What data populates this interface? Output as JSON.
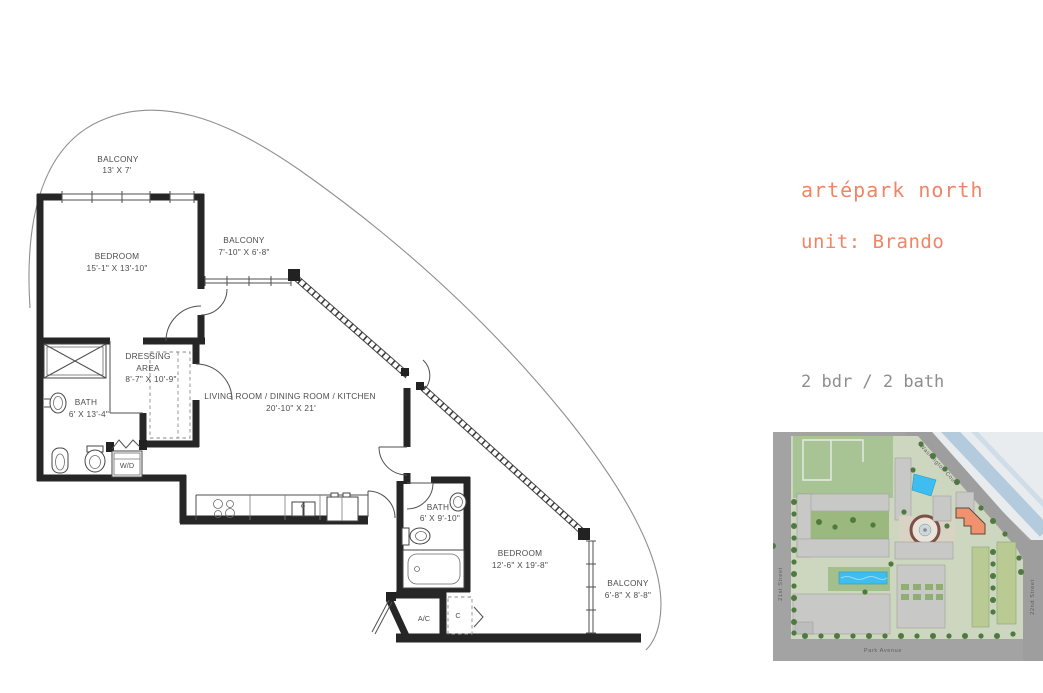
{
  "info_panel": {
    "project_title": "artépark north",
    "unit_line": "unit: Brando",
    "spec_lines": [
      "2 bdr / 2 bath",
      "interior: 1314 sf.",
      "balconies: 223 sf."
    ],
    "accent_color": "#f08566",
    "text_color": "#8e8e8e"
  },
  "floor_plan": {
    "label_color": "#4d4d4d",
    "rooms": {
      "balcony1": {
        "name": "BALCONY",
        "dims": "13' X 7'"
      },
      "bedroom1": {
        "name": "BEDROOM",
        "dims": "15'-1\" X 13'-10\""
      },
      "balcony2": {
        "name": "BALCONY",
        "dims": "7'-10\" X 6'-8\""
      },
      "dressing": {
        "line1": "DRESSING",
        "line2": "AREA",
        "dims": "8'-7\" X 10'-9\""
      },
      "bath1": {
        "name": "BATH",
        "dims": "6' X 13'-4\""
      },
      "living": {
        "name": "LIVING ROOM / DINING ROOM / KITCHEN",
        "dims": "20'-10\" X 21'"
      },
      "bath2": {
        "name": "BATH",
        "dims": "6' X 9'-10\""
      },
      "bedroom2": {
        "name": "BEDROOM",
        "dims": "12'-6\" X 19'-8\""
      },
      "balcony3": {
        "name": "BALCONY",
        "dims": "6'-8\" X 8'-8\""
      },
      "laundry": {
        "name": "W/D"
      },
      "ac": {
        "name": "A/C"
      },
      "closet": {
        "name": "C"
      }
    }
  },
  "site_map": {
    "streets": {
      "top": "Washington Court",
      "left": "21st Street",
      "right": "22nd Street",
      "bottom": "Park Avenue"
    },
    "highlight_color": "#f0926e"
  }
}
